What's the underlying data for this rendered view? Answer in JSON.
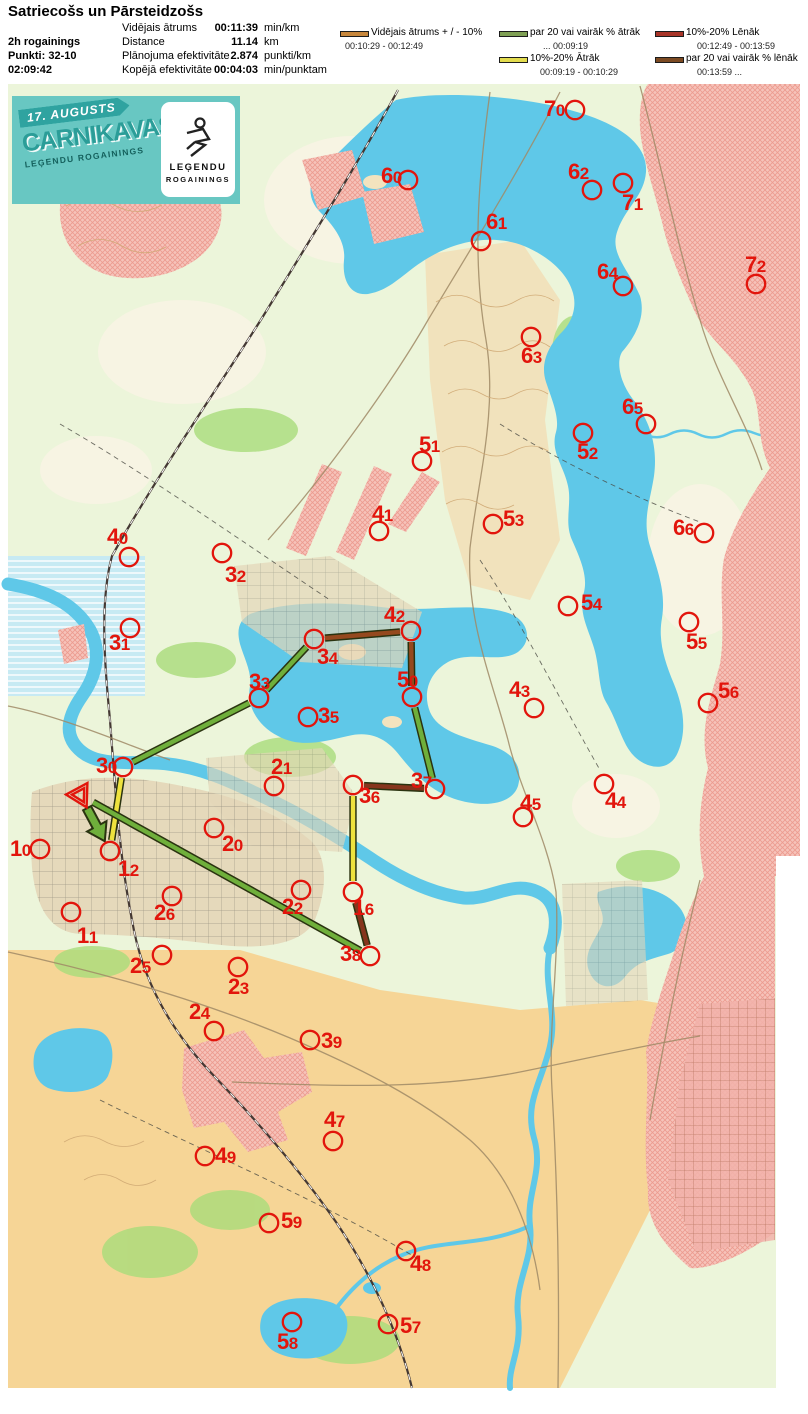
{
  "header": {
    "title": "Satriecošs un Pārsteidzošs",
    "left": {
      "line1": "2h rogainings",
      "line2": "Punkti: 32-10",
      "line3": "02:09:42"
    },
    "stats": [
      {
        "label": "Vidējais ātrums",
        "value": "00:11:39",
        "unit": "min/km"
      },
      {
        "label": "Distance",
        "value": "11.14",
        "unit": "km"
      },
      {
        "label": "Plānojuma efektivitāte",
        "value": "2.874",
        "unit": "punkti/km"
      },
      {
        "label": "Kopējā efektivitāte",
        "value": "00:04:03",
        "unit": "min/punktam"
      }
    ],
    "legend": [
      {
        "label": "Vidējais ātrums + / - 10%",
        "range": "00:10:29   -   00:12:49",
        "color": "#C8873C"
      },
      {
        "label": "par 20 vai vairāk % ātrāk",
        "range": "...    00:09:19",
        "color": "#7FA054"
      },
      {
        "label": "10%-20% Ātrāk",
        "range": "00:09:19   -   00:10:29",
        "color": "#E3DC4E"
      },
      {
        "label": "10%-20% Lēnāk",
        "range": "00:12:49   - 00:13:59",
        "color": "#A83428"
      },
      {
        "label": "par 20 vai vairāk % lēnāk",
        "range": "00:13:59   ...",
        "color": "#7C4A22"
      }
    ]
  },
  "banner": {
    "date": "17. AUGUSTS",
    "title": "CARNIKAVAS",
    "subtitle": "LEĢENDU ROGAININGS",
    "logo_line1": "LEĢENDU",
    "logo_line2": "ROGAININGS"
  },
  "map": {
    "colors": {
      "fast20": "#6FAF3B",
      "fast10": "#EEE23E",
      "slow20": "#95491E",
      "slow10": "#86351D",
      "outline": "#2A3310",
      "control": "#E2150C"
    },
    "start": {
      "x": 80,
      "y": 795
    },
    "controls": [
      {
        "id": "70",
        "cx": 575,
        "cy": 110,
        "lx": 544,
        "ly": 99
      },
      {
        "id": "60",
        "cx": 408,
        "cy": 180,
        "lx": 381,
        "ly": 166
      },
      {
        "id": "62",
        "cx": 592,
        "cy": 190,
        "lx": 568,
        "ly": 162
      },
      {
        "id": "71",
        "cx": 623,
        "cy": 183,
        "lx": 622,
        "ly": 193
      },
      {
        "id": "61",
        "cx": 481,
        "cy": 241,
        "lx": 486,
        "ly": 212
      },
      {
        "id": "64",
        "cx": 623,
        "cy": 286,
        "lx": 597,
        "ly": 262
      },
      {
        "id": "72",
        "cx": 756,
        "cy": 284,
        "lx": 745,
        "ly": 255
      },
      {
        "id": "63",
        "cx": 531,
        "cy": 337,
        "lx": 521,
        "ly": 346
      },
      {
        "id": "65",
        "cx": 646,
        "cy": 424,
        "lx": 622,
        "ly": 397
      },
      {
        "id": "52",
        "cx": 583,
        "cy": 433,
        "lx": 577,
        "ly": 442
      },
      {
        "id": "51",
        "cx": 422,
        "cy": 461,
        "lx": 419,
        "ly": 435
      },
      {
        "id": "41",
        "cx": 379,
        "cy": 531,
        "lx": 372,
        "ly": 504
      },
      {
        "id": "53",
        "cx": 493,
        "cy": 524,
        "lx": 503,
        "ly": 509
      },
      {
        "id": "40",
        "cx": 129,
        "cy": 557,
        "lx": 107,
        "ly": 527
      },
      {
        "id": "32",
        "cx": 222,
        "cy": 553,
        "lx": 225,
        "ly": 565
      },
      {
        "id": "31",
        "cx": 130,
        "cy": 628,
        "lx": 109,
        "ly": 633
      },
      {
        "id": "54",
        "cx": 568,
        "cy": 606,
        "lx": 581,
        "ly": 593
      },
      {
        "id": "66",
        "cx": 704,
        "cy": 533,
        "lx": 673,
        "ly": 518
      },
      {
        "id": "55",
        "cx": 689,
        "cy": 622,
        "lx": 686,
        "ly": 632
      },
      {
        "id": "56",
        "cx": 708,
        "cy": 703,
        "lx": 718,
        "ly": 681
      },
      {
        "id": "42",
        "cx": 411,
        "cy": 631,
        "lx": 384,
        "ly": 605
      },
      {
        "id": "34",
        "cx": 314,
        "cy": 639,
        "lx": 317,
        "ly": 647
      },
      {
        "id": "33",
        "cx": 259,
        "cy": 698,
        "lx": 249,
        "ly": 672
      },
      {
        "id": "50",
        "cx": 412,
        "cy": 697,
        "lx": 397,
        "ly": 670
      },
      {
        "id": "35",
        "cx": 308,
        "cy": 717,
        "lx": 318,
        "ly": 706
      },
      {
        "id": "43",
        "cx": 534,
        "cy": 708,
        "lx": 509,
        "ly": 680
      },
      {
        "id": "44",
        "cx": 604,
        "cy": 784,
        "lx": 605,
        "ly": 791
      },
      {
        "id": "45",
        "cx": 523,
        "cy": 817,
        "lx": 520,
        "ly": 793
      },
      {
        "id": "30",
        "cx": 123,
        "cy": 767,
        "lx": 96,
        "ly": 756
      },
      {
        "id": "21",
        "cx": 274,
        "cy": 786,
        "lx": 271,
        "ly": 757
      },
      {
        "id": "36",
        "cx": 353,
        "cy": 785,
        "lx": 359,
        "ly": 786
      },
      {
        "id": "37",
        "cx": 435,
        "cy": 789,
        "lx": 411,
        "ly": 771
      },
      {
        "id": "20",
        "cx": 214,
        "cy": 828,
        "lx": 222,
        "ly": 834
      },
      {
        "id": "10",
        "cx": 40,
        "cy": 849,
        "lx": 10,
        "ly": 839
      },
      {
        "id": "12",
        "cx": 110,
        "cy": 851,
        "lx": 118,
        "ly": 859
      },
      {
        "id": "22",
        "cx": 301,
        "cy": 890,
        "lx": 282,
        "ly": 897
      },
      {
        "id": "11",
        "cx": 71,
        "cy": 912,
        "lx": 77,
        "ly": 926
      },
      {
        "id": "26",
        "cx": 172,
        "cy": 896,
        "lx": 154,
        "ly": 903
      },
      {
        "id": "16",
        "cx": 353,
        "cy": 892,
        "lx": 353,
        "ly": 898
      },
      {
        "id": "25",
        "cx": 162,
        "cy": 955,
        "lx": 130,
        "ly": 956
      },
      {
        "id": "38",
        "cx": 370,
        "cy": 956,
        "lx": 340,
        "ly": 944
      },
      {
        "id": "23",
        "cx": 238,
        "cy": 967,
        "lx": 228,
        "ly": 977
      },
      {
        "id": "24",
        "cx": 214,
        "cy": 1031,
        "lx": 189,
        "ly": 1002
      },
      {
        "id": "39",
        "cx": 310,
        "cy": 1040,
        "lx": 321,
        "ly": 1031
      },
      {
        "id": "47",
        "cx": 333,
        "cy": 1141,
        "lx": 324,
        "ly": 1110
      },
      {
        "id": "49",
        "cx": 205,
        "cy": 1156,
        "lx": 215,
        "ly": 1146
      },
      {
        "id": "59",
        "cx": 269,
        "cy": 1223,
        "lx": 281,
        "ly": 1211
      },
      {
        "id": "48",
        "cx": 406,
        "cy": 1251,
        "lx": 410,
        "ly": 1254
      },
      {
        "id": "58",
        "cx": 292,
        "cy": 1322,
        "lx": 277,
        "ly": 1332
      },
      {
        "id": "57",
        "cx": 388,
        "cy": 1324,
        "lx": 400,
        "ly": 1316
      }
    ],
    "route": [
      {
        "from": "start",
        "to": "12",
        "cat": "fast20",
        "arrow": true
      },
      {
        "from": "12",
        "to": "30",
        "cat": "fast10"
      },
      {
        "from": "30",
        "to": "33",
        "cat": "fast20"
      },
      {
        "from": "33",
        "to": "34",
        "cat": "fast20"
      },
      {
        "from": "34",
        "to": "42",
        "cat": "slow20"
      },
      {
        "from": "42",
        "to": "50",
        "cat": "slow20"
      },
      {
        "from": "50",
        "to": "37",
        "cat": "fast20"
      },
      {
        "from": "37",
        "to": "36",
        "cat": "slow10"
      },
      {
        "from": "36",
        "to": "16",
        "cat": "fast10"
      },
      {
        "from": "16",
        "to": "38",
        "cat": "slow10"
      },
      {
        "from": "38",
        "to": "start",
        "cat": "fast20"
      }
    ]
  }
}
